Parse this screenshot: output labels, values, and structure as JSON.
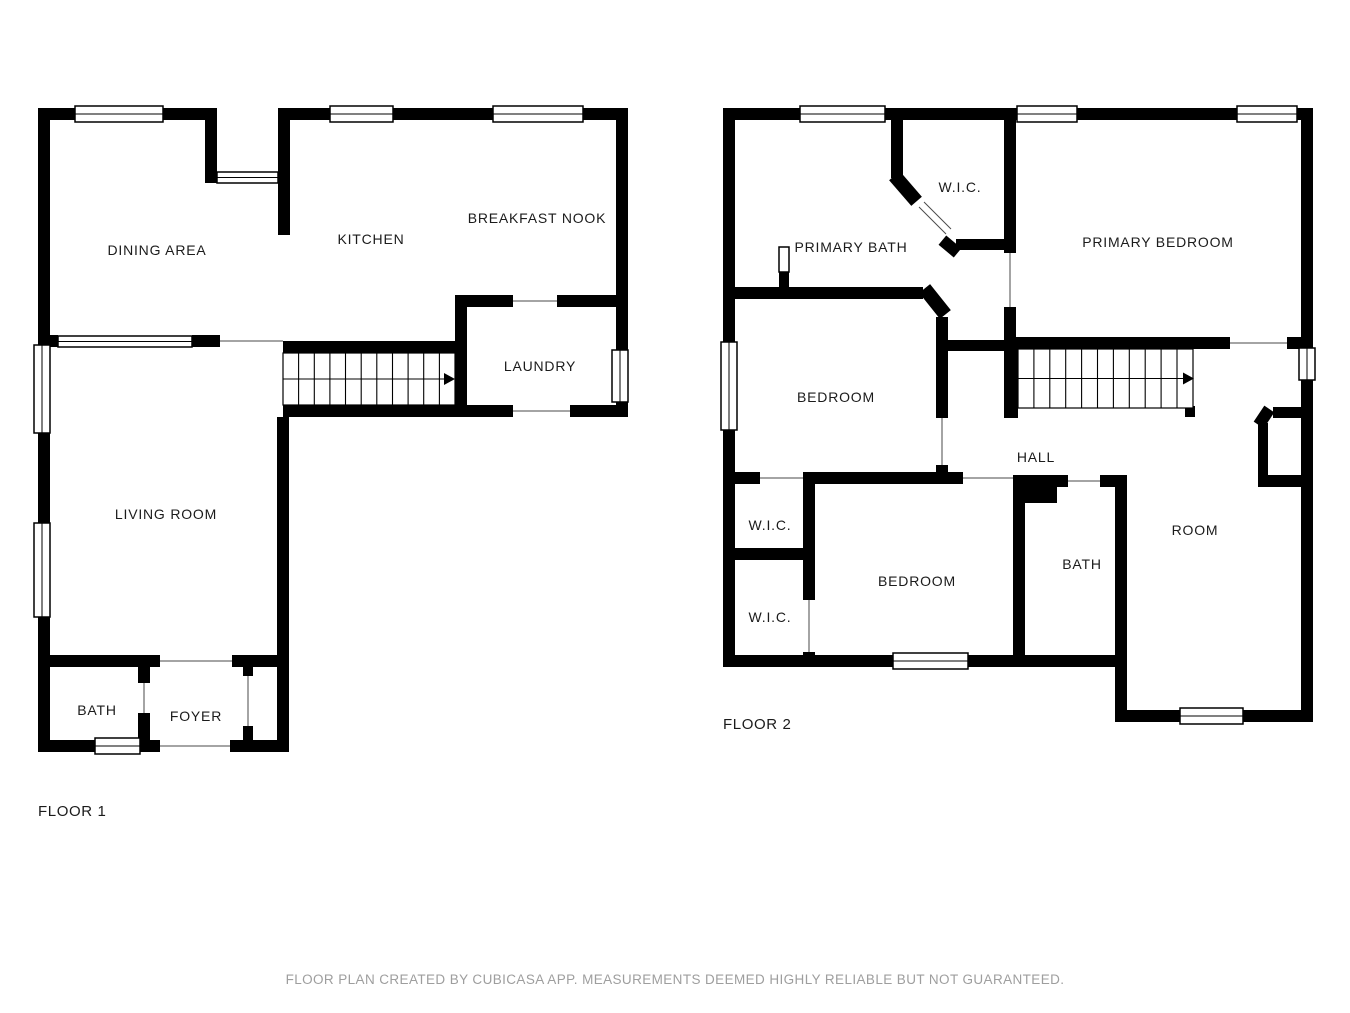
{
  "floor1": {
    "label": "FLOOR 1",
    "rooms": [
      {
        "name": "dining-area",
        "label": "DINING AREA"
      },
      {
        "name": "kitchen",
        "label": "KITCHEN"
      },
      {
        "name": "breakfast-nook",
        "label": "BREAKFAST NOOK"
      },
      {
        "name": "laundry",
        "label": "LAUNDRY"
      },
      {
        "name": "living-room",
        "label": "LIVING ROOM"
      },
      {
        "name": "bath",
        "label": "BATH"
      },
      {
        "name": "foyer",
        "label": "FOYER"
      }
    ]
  },
  "floor2": {
    "label": "FLOOR 2",
    "rooms": [
      {
        "name": "wic-top",
        "label": "W.I.C."
      },
      {
        "name": "primary-bath",
        "label": "PRIMARY BATH"
      },
      {
        "name": "primary-bedroom",
        "label": "PRIMARY BEDROOM"
      },
      {
        "name": "bedroom-left",
        "label": "BEDROOM"
      },
      {
        "name": "hall",
        "label": "HALL"
      },
      {
        "name": "wic-middle",
        "label": "W.I.C."
      },
      {
        "name": "wic-lower",
        "label": "W.I.C."
      },
      {
        "name": "bedroom-lower",
        "label": "BEDROOM"
      },
      {
        "name": "bath2",
        "label": "BATH"
      },
      {
        "name": "room",
        "label": "ROOM"
      }
    ]
  },
  "footer": {
    "disclaimer": "FLOOR PLAN CREATED BY CUBICASA APP. MEASUREMENTS DEEMED HIGHLY RELIABLE BUT NOT GUARANTEED."
  },
  "colors": {
    "wall": "#000000",
    "background": "#ffffff",
    "label": "#1b1b1b",
    "disclaimer_text": "#9e9e9e"
  }
}
